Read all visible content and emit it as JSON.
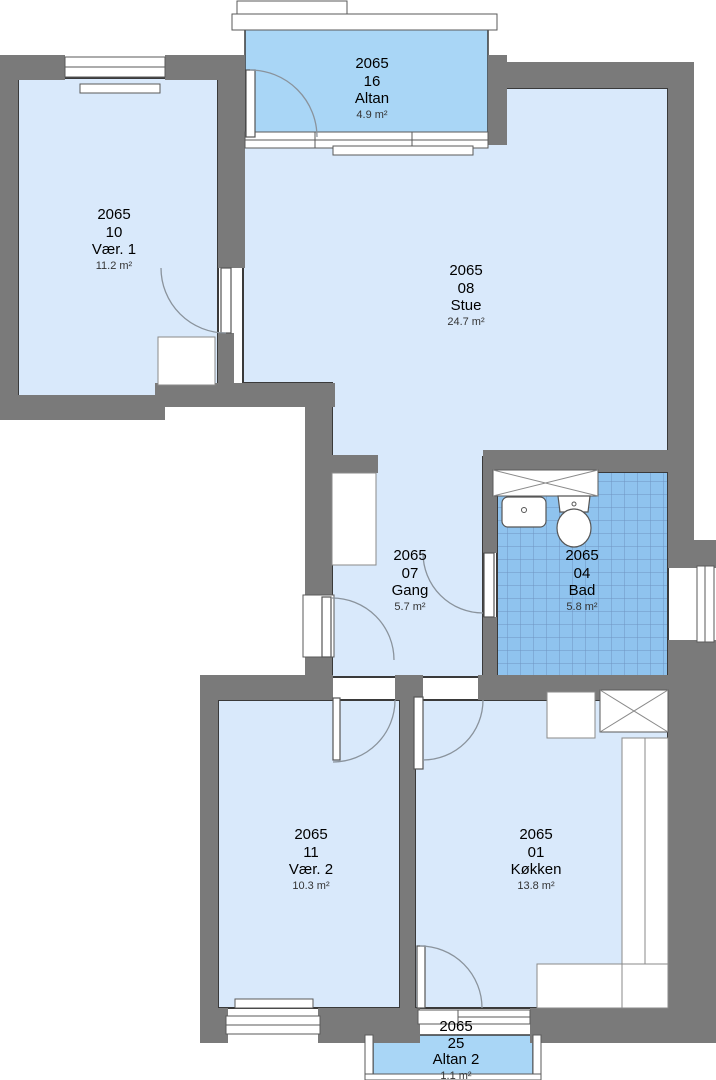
{
  "plan": {
    "estate_number": "2065",
    "rooms": [
      {
        "key": "altan",
        "estate": "2065",
        "unit": "16",
        "name": "Altan",
        "area": "4.9 m²"
      },
      {
        "key": "vaer1",
        "estate": "2065",
        "unit": "10",
        "name": "Vær. 1",
        "area": "11.2 m²"
      },
      {
        "key": "stue",
        "estate": "2065",
        "unit": "08",
        "name": "Stue",
        "area": "24.7 m²"
      },
      {
        "key": "gang",
        "estate": "2065",
        "unit": "07",
        "name": "Gang",
        "area": "5.7 m²"
      },
      {
        "key": "bad",
        "estate": "2065",
        "unit": "04",
        "name": "Bad",
        "area": "5.8 m²"
      },
      {
        "key": "vaer2",
        "estate": "2065",
        "unit": "11",
        "name": "Vær. 2",
        "area": "10.3 m²"
      },
      {
        "key": "koekken",
        "estate": "2065",
        "unit": "01",
        "name": "Køkken",
        "area": "13.8 m²"
      },
      {
        "key": "altan2",
        "estate": "2065",
        "unit": "25",
        "name": "Altan 2",
        "area": "1.1 m²"
      }
    ],
    "colors": {
      "wall": "#7a7a7a",
      "room_fill": "#d9e9fb",
      "balcony_fill": "#a9d6f6",
      "bath_fill": "#8fc3ee",
      "outline": "#3a3a3a"
    },
    "fixture_icons": [
      "sink-icon",
      "toilet-icon",
      "radiator-icon",
      "kitchen-counter-icon",
      "wardrobe-icon",
      "shaft-cross-icon",
      "door-swing-icon",
      "window-icon"
    ]
  }
}
